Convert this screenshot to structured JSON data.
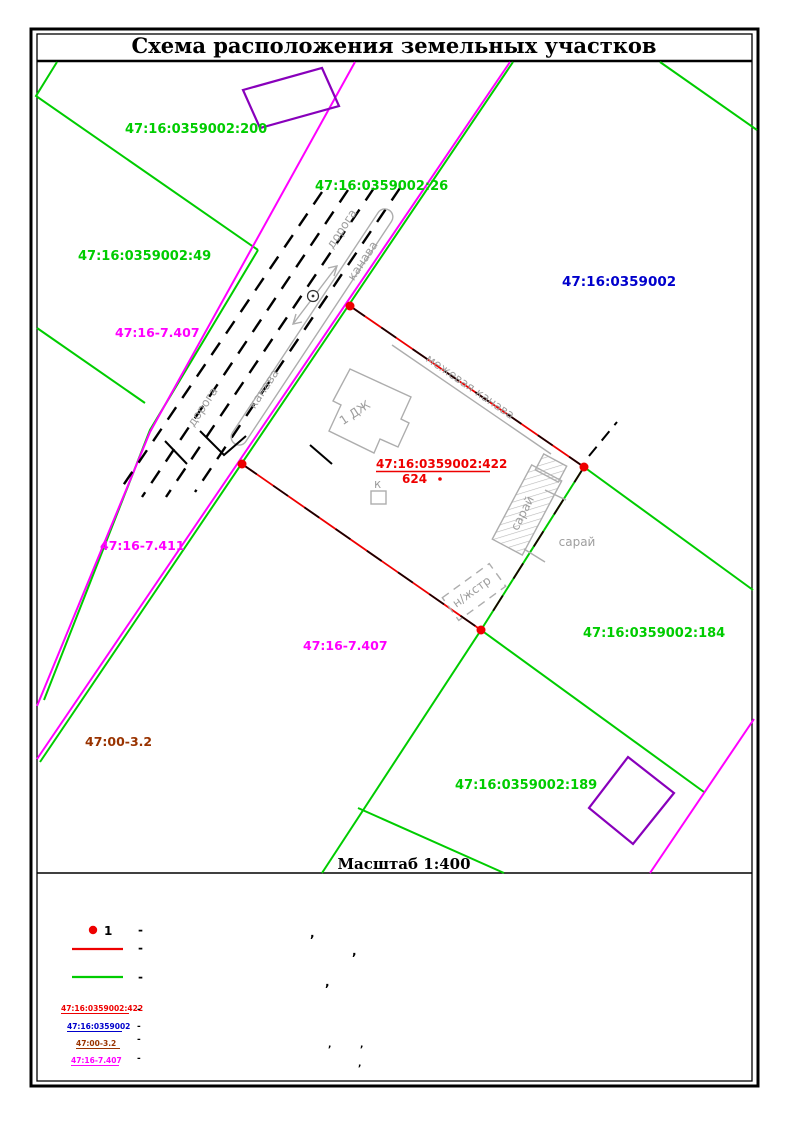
{
  "title": "Схема расположения земельных участков",
  "map": {
    "scale_label": "Масштаб 1:400",
    "parcels": {
      "p200": "47:16:0359002:200",
      "p26": "47:16:0359002:26",
      "p49": "47:16:0359002:49",
      "p7407_upper": "47:16-7.407",
      "quarter": "47:16:0359002",
      "p7411": "47:16-7.411",
      "p422": "47:16:0359002:422",
      "p422_number": "624",
      "p7407_lower": "47:16-7.407",
      "p184": "47:16:0359002:184",
      "p00_32": "47:00-3.2",
      "p189": "47:16:0359002:189"
    },
    "annotations": {
      "road_upper": "дорога",
      "ditch_upper": "канава",
      "ditch_lower": "канава",
      "road_lower": "дорога",
      "boundary_ditch": "межевая канава",
      "house": "1 ДЖ",
      "outbuilding_k": "к",
      "shed_rotated": "сарай",
      "shed_right": "сарай",
      "nonresidential": "н/жстр"
    }
  },
  "legend": {
    "point_number": "1",
    "separator": "-",
    "comma": ",",
    "label_422": "47:16:0359002:422",
    "label_quarter": "47:16:0359002",
    "label_00_32": "47:00-3.2",
    "label_7_407": "47:16-7.407"
  },
  "colors": {
    "parcel_green": "#00cc00",
    "boundary_magenta": "#ff00ff",
    "building_purple": "#8800bb",
    "boundary_red": "#ee0000",
    "quarter_blue": "#0000cc",
    "zone_brown": "#993300",
    "topo_gray": "#9e9e9e"
  }
}
